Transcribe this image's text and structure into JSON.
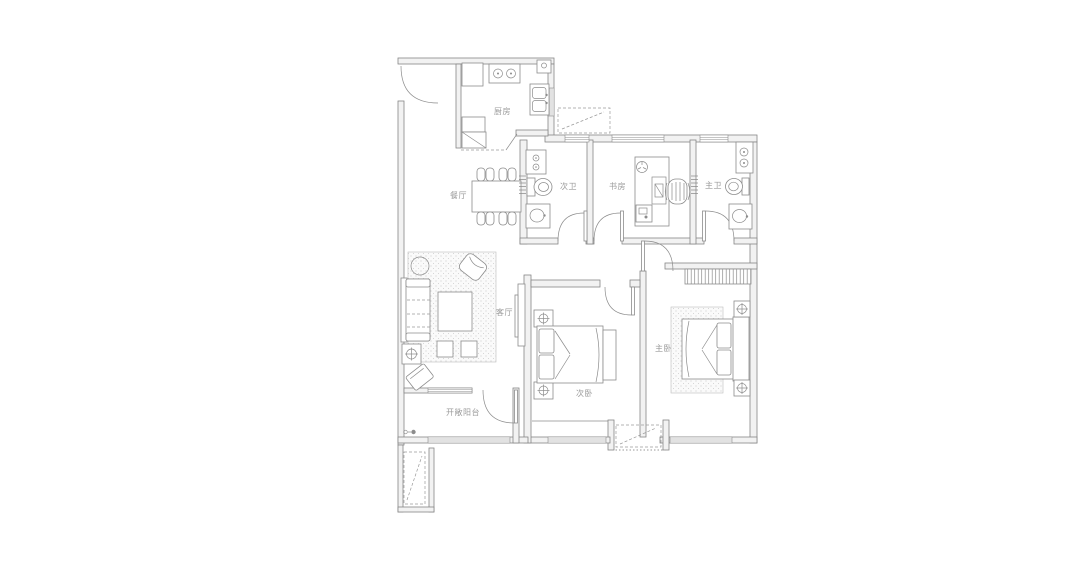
{
  "rooms": {
    "kitchen": {
      "label": "厨房"
    },
    "dining": {
      "label": "餐厅"
    },
    "bath_secondary": {
      "label": "次卫"
    },
    "study": {
      "label": "书房"
    },
    "bath_master": {
      "label": "主卫"
    },
    "living": {
      "label": "客厅"
    },
    "bedroom_secondary": {
      "label": "次卧"
    },
    "bedroom_master": {
      "label": "主卧"
    },
    "balcony": {
      "label": "开敞阳台"
    }
  },
  "colors": {
    "background": "#ffffff",
    "line": "#8c8c8c",
    "wall_fill": "#f2f2f2",
    "label_text": "#9a9a9a"
  }
}
